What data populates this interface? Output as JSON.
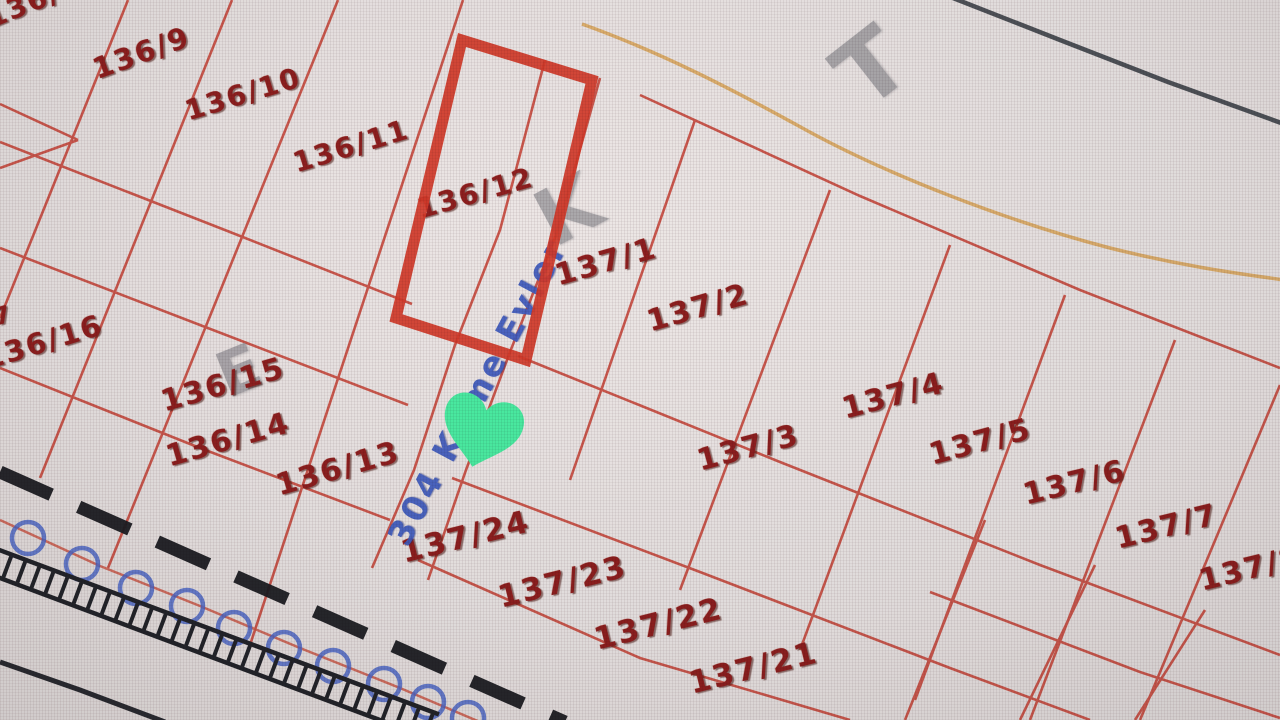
{
  "map_title": "Kadastro parsel haritası",
  "street_label": {
    "text": "304 Küme Evler",
    "color": "#3f5cc0"
  },
  "marker": {
    "type": "heart",
    "color": "#4aeea3"
  },
  "selected_parcel": {
    "outline_color": "#d23a2a"
  },
  "parcel_labels": [
    {
      "text": "136/8",
      "x": -12,
      "y": 6,
      "rot": -22,
      "fs": 28
    },
    {
      "text": "136/9",
      "x": 94,
      "y": 56,
      "rot": -20,
      "fs": 29
    },
    {
      "text": "136/10",
      "x": 186,
      "y": 98,
      "rot": -17,
      "fs": 28
    },
    {
      "text": "136/11",
      "x": 294,
      "y": 150,
      "rot": -17,
      "fs": 28
    },
    {
      "text": "136/12",
      "x": 418,
      "y": 196,
      "rot": -16,
      "fs": 28
    },
    {
      "text": "137/1",
      "x": 556,
      "y": 262,
      "rot": -16,
      "fs": 30
    },
    {
      "text": "137/2",
      "x": 648,
      "y": 308,
      "rot": -16,
      "fs": 30
    },
    {
      "text": "137/4",
      "x": 843,
      "y": 395,
      "rot": -15,
      "fs": 30
    },
    {
      "text": "137/5",
      "x": 930,
      "y": 441,
      "rot": -15,
      "fs": 30
    },
    {
      "text": "137/3",
      "x": 698,
      "y": 447,
      "rot": -15,
      "fs": 30
    },
    {
      "text": "137/6",
      "x": 1024,
      "y": 481,
      "rot": -14,
      "fs": 30
    },
    {
      "text": "137/7",
      "x": 1116,
      "y": 525,
      "rot": -14,
      "fs": 30
    },
    {
      "text": "137/8",
      "x": 1200,
      "y": 567,
      "rot": -14,
      "fs": 30
    },
    {
      "text": "7",
      "x": -6,
      "y": 306,
      "rot": -16,
      "fs": 24
    },
    {
      "text": "136/16",
      "x": -16,
      "y": 346,
      "rot": -17,
      "fs": 29
    },
    {
      "text": "136/15",
      "x": 162,
      "y": 388,
      "rot": -16,
      "fs": 30
    },
    {
      "text": "136/14",
      "x": 167,
      "y": 443,
      "rot": -16,
      "fs": 30
    },
    {
      "text": "136/13",
      "x": 277,
      "y": 472,
      "rot": -16,
      "fs": 30
    },
    {
      "text": "137/24",
      "x": 402,
      "y": 538,
      "rot": -14,
      "fs": 31
    },
    {
      "text": "137/23",
      "x": 499,
      "y": 583,
      "rot": -14,
      "fs": 31
    },
    {
      "text": "137/22",
      "x": 595,
      "y": 625,
      "rot": -14,
      "fs": 31
    },
    {
      "text": "137/21",
      "x": 690,
      "y": 669,
      "rot": -14,
      "fs": 31
    }
  ],
  "watermark_letters": [
    {
      "text": "T",
      "x": 840,
      "y": 22,
      "rot": -38,
      "fs": 92
    },
    {
      "text": "K",
      "x": 538,
      "y": 172,
      "rot": -28,
      "fs": 78
    },
    {
      "text": "E",
      "x": 218,
      "y": 340,
      "rot": -22,
      "fs": 62
    }
  ],
  "colors": {
    "parcel_line": "#c8463a",
    "parcel_text": "#8e1f1f",
    "selected_outline": "#d23a2a",
    "street_text": "#3f5cc0",
    "marker_green": "#4aeea3",
    "contour_orange": "#dcaa60",
    "boundary_dark": "#41464d",
    "symbol_black": "#1c1d22",
    "pole_blue": "#4a66c8",
    "background": "#eae7e5"
  }
}
